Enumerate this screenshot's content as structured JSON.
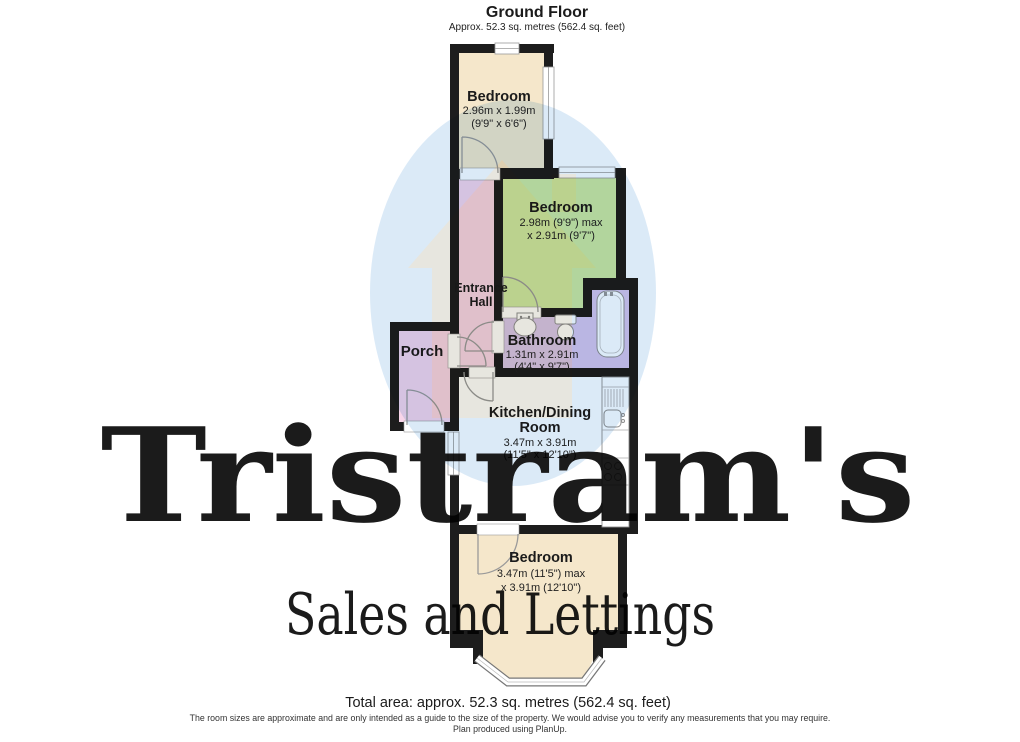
{
  "header": {
    "title": "Ground Floor",
    "subtitle": "Approx. 52.3 sq. metres (562.4 sq. feet)"
  },
  "rooms": {
    "bedroom_top": {
      "name": "Bedroom",
      "dim_metric": "2.96m x 1.99m",
      "dim_imperial": "(9'9\" x 6'6\")"
    },
    "bedroom_middle": {
      "name": "Bedroom",
      "dim_line1": "2.98m (9'9\") max",
      "dim_line2": "x 2.91m (9'7\")"
    },
    "entrance_hall": {
      "name_line1": "Entrance",
      "name_line2": "Hall"
    },
    "porch": {
      "name": "Porch"
    },
    "bathroom": {
      "name": "Bathroom",
      "dim_metric": "1.31m x 2.91m",
      "dim_imperial": "(4'4\" x 9'7\")"
    },
    "kitchen": {
      "name_line1": "Kitchen/Dining",
      "name_line2": "Room",
      "dim_metric": "3.47m x 3.91m",
      "dim_imperial": "(11'5\" x 12'10\")"
    },
    "bedroom_bottom": {
      "name": "Bedroom",
      "dim_line1": "3.47m (11'5\") max",
      "dim_line2": "x 3.91m (12'10\")"
    }
  },
  "footer": {
    "total_area": "Total area: approx. 52.3 sq. metres (562.4 sq. feet)",
    "disclaimer": "The room sizes are approximate and are only intended as a guide to the size of the property. We would advise you to verify any measurements that you may require.",
    "credit": "Plan produced using PlanUp."
  },
  "watermark": {
    "brand": "Tristram's",
    "tagline": "Sales and Lettings"
  },
  "colors": {
    "wall": "#1d1d1d",
    "bedroom_fill": "#f5e7cb",
    "green_bedroom_fill": "#cfe9a2",
    "hall_porch_fill": "#f8d5e9",
    "bathroom_fill": "#d9c7eb",
    "kitchen_fill": "#ffffff",
    "door_line": "#9a9a9a",
    "fixture_line": "#8f8f8f",
    "watermark_circle": "#bed8f0",
    "watermark_house": "#f4e4c8",
    "watermark_brand": "#cae0f6",
    "watermark_tagline": "#d9e5f1"
  }
}
